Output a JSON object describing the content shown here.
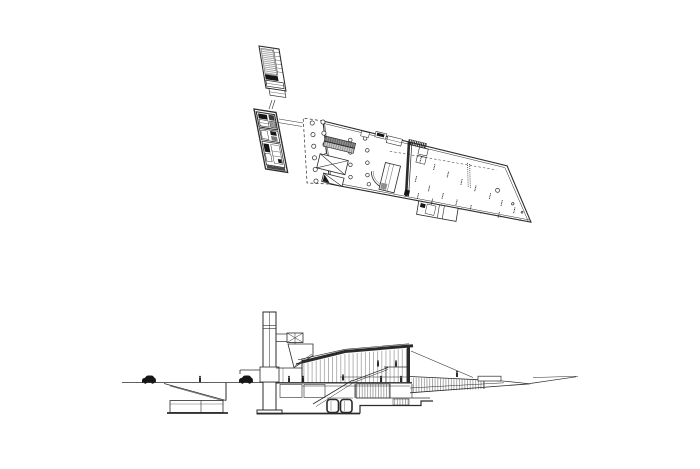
{
  "figure": {
    "type": "architectural-drawing",
    "views": [
      "floor-plan",
      "longitudinal-section"
    ]
  },
  "colors": {
    "background": "#ffffff",
    "line": "#2b2b2b",
    "poche": "#161616",
    "gray_dark": "#8f8f8f",
    "gray_light": "#c9c9c9",
    "hatch": "#4a4a4a"
  },
  "plan": {
    "columns": [
      {
        "target": "cols-a",
        "r": 2.1,
        "points": [
          [
            -10,
            4.5
          ],
          [
            -6.5,
            15.6
          ],
          [
            -3,
            26.7
          ],
          [
            0.5,
            37.8
          ],
          [
            3.9,
            48.9
          ],
          [
            7.4,
            60
          ]
        ]
      },
      {
        "target": "cols-b",
        "r": 2.1,
        "points": [
          [
            0.2,
            1
          ],
          [
            3.8,
            11.6
          ],
          [
            7.5,
            22.2
          ],
          [
            11.1,
            32.9
          ],
          [
            14.8,
            43.5
          ],
          [
            18.4,
            54.2
          ]
        ]
      },
      {
        "target": "cols-int",
        "r": 1.8,
        "points": [
          [
            31,
            12
          ],
          [
            34,
            24
          ],
          [
            37,
            36
          ],
          [
            40,
            48
          ],
          [
            45,
            7
          ],
          [
            50,
            18
          ],
          [
            53,
            30
          ],
          [
            56,
            42
          ],
          [
            59.5,
            50.5
          ]
        ]
      },
      {
        "target": "cols-hall",
        "r": 1.5,
        "points": [
          [
            186,
            26,
            2
          ],
          [
            204,
            35.5,
            1.2
          ],
          [
            215,
            41.5,
            0.9
          ]
        ]
      }
    ],
    "dot_clusters": [
      [
        104,
        12
      ],
      [
        104,
        32
      ],
      [
        119,
        16
      ],
      [
        119,
        38
      ],
      [
        134,
        20
      ],
      [
        134,
        42
      ],
      [
        149,
        24
      ],
      [
        149,
        45
      ],
      [
        164,
        27
      ],
      [
        164,
        47
      ],
      [
        180,
        31
      ],
      [
        193,
        35
      ],
      [
        193,
        47
      ],
      [
        207,
        39
      ],
      [
        110,
        48
      ],
      [
        125,
        50
      ]
    ],
    "seat_rows": [
      {
        "from": [
          150.5,
          7
        ],
        "to": [
          156.5,
          29
        ],
        "n": 12
      },
      {
        "from": [
          152.8,
          7.5
        ],
        "to": [
          158.8,
          29.5
        ],
        "n": 12
      }
    ]
  },
  "section": {
    "people": [
      [
        200,
        382
      ],
      [
        289,
        382
      ],
      [
        303,
        382
      ],
      [
        343,
        380.5
      ],
      [
        381,
        382
      ],
      [
        401,
        382
      ],
      [
        378,
        366.5
      ],
      [
        396,
        366.5
      ],
      [
        457,
        377
      ]
    ],
    "cars": [
      [
        142,
        382.6
      ],
      [
        239,
        382.6
      ]
    ]
  }
}
